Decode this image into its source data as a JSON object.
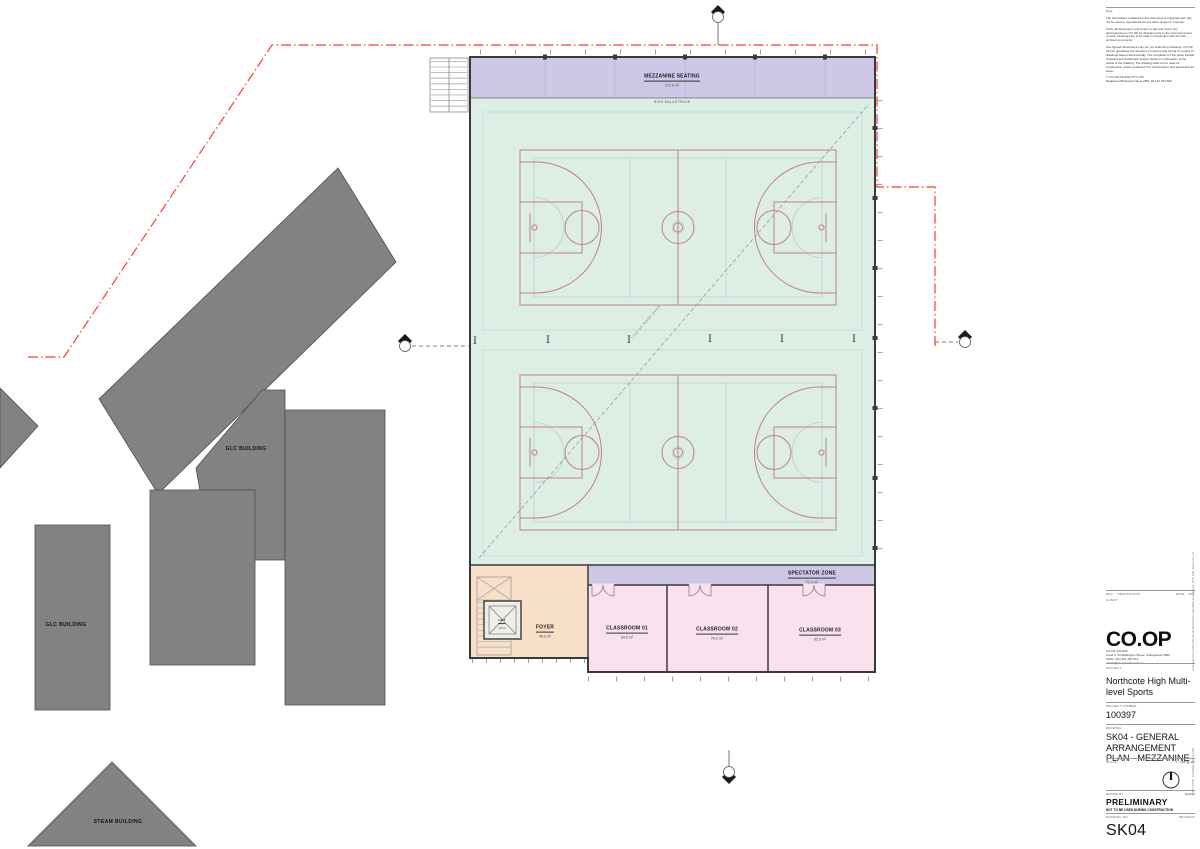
{
  "sheet": {
    "notes": {
      "heading": "Note:",
      "paragraphs": [
        "The information contained in this document is copyright and may not be used or reproduced for any other project or purpose.",
        "Verify all dimensions and levels on site and report any discrepancies to CO.OP for direction prior to the commencement of work. Drawings are to be read in conjunction with all other contract documents.",
        "Use figured dimensions only. Do not scale from drawings. CO.OP cannot guarantee the accuracy of content and format for copies of drawings issued electronically. The completion of the Issue Details Checked and Authorised section below is confirmation of the status of the drawing. The drawing shall not be used for construction unless endorsed 'For Construction' and authorised for issue.",
        "© CO.OP STUDIO PTY LTD\nRegistered Business Name ABN: 63 161 763 600"
      ]
    },
    "rev_table": {
      "rev": "REV.",
      "description": "DESCRIPTION",
      "date": "DATE",
      "app": "APP"
    },
    "client_label": "CLIENT",
    "logo_text": "CO.OP",
    "firm_lines": [
      "CO.OP STUDIO",
      "Level 4, 54 Wellington Street, Collingwood 3066",
      "Office: (61) 421 267 014",
      "admin@co-opstudio.com.au"
    ],
    "project_label": "PROJECT",
    "project_name": "Northcote High Multi-level Sports",
    "project_number_label": "PROJECT NUMBER",
    "project_number": "100397",
    "drawing_label": "DRAWING",
    "drawing_title": "SK04 - GENERAL ARRANGEMENT PLAN - MEZZANINE",
    "scale_label": "SCALE",
    "scale_value": "1 : 100 @ A0",
    "drawn_by_label": "DRAWN BY",
    "drawn_by_value": "Author",
    "status": "PRELIMINARY",
    "status_note": "NOT TO BE USED DURING CONSTRUCTION",
    "drawing_no_label": "DRAWING NO.",
    "revision_label": "REVISION",
    "drawing_no": "SK04",
    "file_reference": "Autodesk Docs://CO.OP Studio/Northcote High Multi-level Sports_R23_GM_Option 01.rvt",
    "plot_date": "PLOT DATE: 2/11/2023 3:53:23 PM"
  },
  "plan": {
    "rooms": {
      "mezzanine": {
        "name": "MEZZANINE SEATING",
        "area": "172.9 m²"
      },
      "spectator": {
        "name": "SPECTATOR ZONE",
        "area": "71.0 m²"
      },
      "foyer": {
        "name": "FOYER",
        "area": "45.2 m²"
      },
      "lift": {
        "name": "LIFT",
        "area": "3.6 m²"
      },
      "classroom1": {
        "name": "CLASSROOM 01",
        "area": "64.5 m²"
      },
      "classroom2": {
        "name": "CLASSROOM 02",
        "area": "76.2 m²"
      },
      "classroom3": {
        "name": "CLASSROOM 03",
        "area": "62.5 m²"
      }
    },
    "annotations": {
      "high_balustrade": "HIGH BALUSTRADE",
      "roof_line": "LINE OF ROOF OVER"
    },
    "context": {
      "glc_upper": "GLC BUILDING",
      "glc_lower": "GLC BUILDING",
      "steam": "STEAM BUILDING"
    },
    "colors": {
      "hall": "#ddefe5",
      "mezzanine_zone": "#cdc8e6",
      "classroom_zone": "#f9e2ee",
      "foyer_zone": "#f8dfc8",
      "court_line": "#c1807d",
      "site_boundary": "#ff3b30",
      "context_building": "#828282"
    }
  }
}
